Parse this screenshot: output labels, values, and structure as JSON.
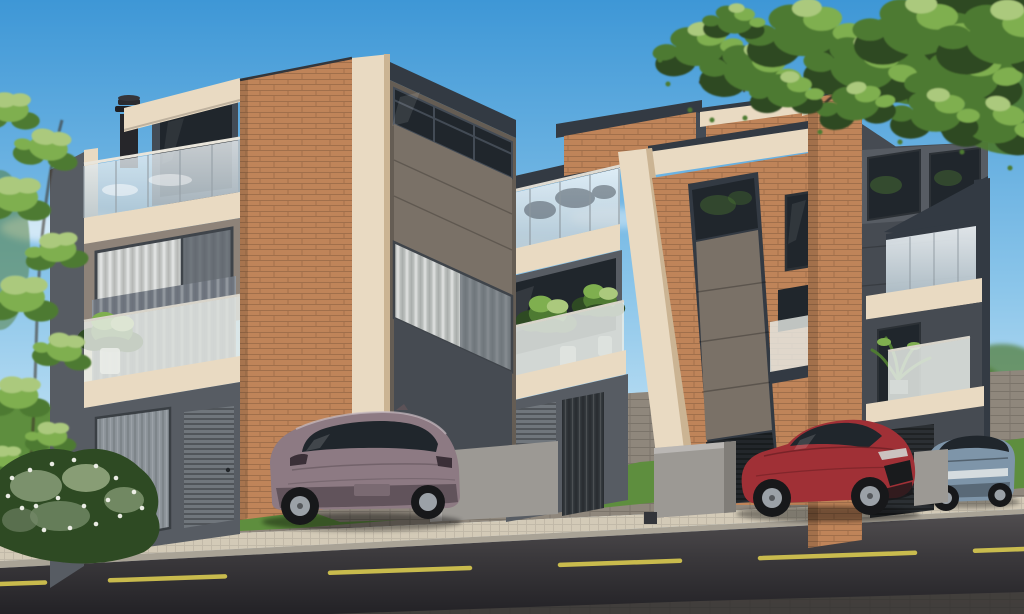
{
  "meta": {
    "title": "Architectural 3D rendering of three modern three-story townhouses with glass balconies, front lawns, parked cars and a street",
    "render_type": "photorealistic-exterior-render",
    "width_px": 1024,
    "height_px": 614
  },
  "scene": {
    "time_of_day": "day",
    "counts": {
      "townhouses": 3,
      "cars": 3,
      "stories": 3
    },
    "objects": [
      "sky",
      "clouds",
      "tree-canopy-top-right",
      "tree-left-edge",
      "flowering-bush-bottom-left",
      "background-trees-right",
      "background-white-wall-right",
      "background-fence-left",
      "townhouse-left",
      "townhouse-middle",
      "townhouse-right",
      "rooftop-terrace-glass-railing",
      "chimney-flue",
      "brick-feature-walls",
      "beige-concrete-trims",
      "dark-panel-facades",
      "curtained-windows",
      "frosted-balcony-railings",
      "balcony-plants",
      "white-planter-pots",
      "garage-slat-doors",
      "entry-glass-door",
      "mesh-entry-gates",
      "ac-louver-panel",
      "site-divider-walls",
      "trash-bin",
      "car-mauve-hatchback",
      "car-red-sedan",
      "car-blue-gray-sedan",
      "front-lawns",
      "paver-driveway",
      "sidewalk",
      "curb",
      "asphalt-road",
      "road-center-dashed-line"
    ],
    "street": {
      "lane_marking": "yellow-dashed",
      "surface": "asphalt"
    }
  },
  "colors": {
    "sky_top": "#3E97D6",
    "sky_mid": "#8CC6EA",
    "sky_horizon": "#DCEFF9",
    "cloud": "#FFFFFF",
    "foliage_dark": "#2E4A23",
    "foliage_mid": "#4E7A32",
    "foliage_light": "#7FAF4F",
    "foliage_sunlit": "#ABC97D",
    "branch": "#3A3126",
    "flower_white": "#F4F4EE",
    "brick": "#BF8459",
    "brick_shadow": "#9E6B43",
    "beige": "#E9DAC2",
    "beige_shadow": "#CBB493",
    "panel_brown": "#7A7167",
    "panel_brown_dark": "#655D54",
    "charcoal": "#333A43",
    "charcoal_light": "#434B55",
    "wall_taupe": "#8E8379",
    "wall_gray": "#70767C",
    "wall_gray_dark": "#575C63",
    "wall_gray_deep": "#464B52",
    "free_wall_light": "#9C9994",
    "free_wall_shadow": "#807D78",
    "white_wall": "#E9E7E0",
    "glass_dark": "#20262C",
    "frosted": "#E8ECE7",
    "curtain": "#C5C8C6",
    "grass": "#5E8E3E",
    "grass_light": "#76A54D",
    "driveway": "#8F877C",
    "sidewalk": "#D3CAB7",
    "curb": "#A9A396",
    "road_light": "#504D4F",
    "road": "#3A383B",
    "road_dark": "#232226",
    "lane_yellow": "#D9CA50",
    "car_mauve": "#8D7A83",
    "car_mauve_dark": "#5C4F57",
    "car_red": "#A03036",
    "car_red_dark": "#6E2025",
    "car_blue": "#7E95A9",
    "car_blue_dark": "#52616E",
    "tire": "#17181A",
    "rim": "#9BA1A7",
    "pot_white": "#F1F0EA"
  }
}
